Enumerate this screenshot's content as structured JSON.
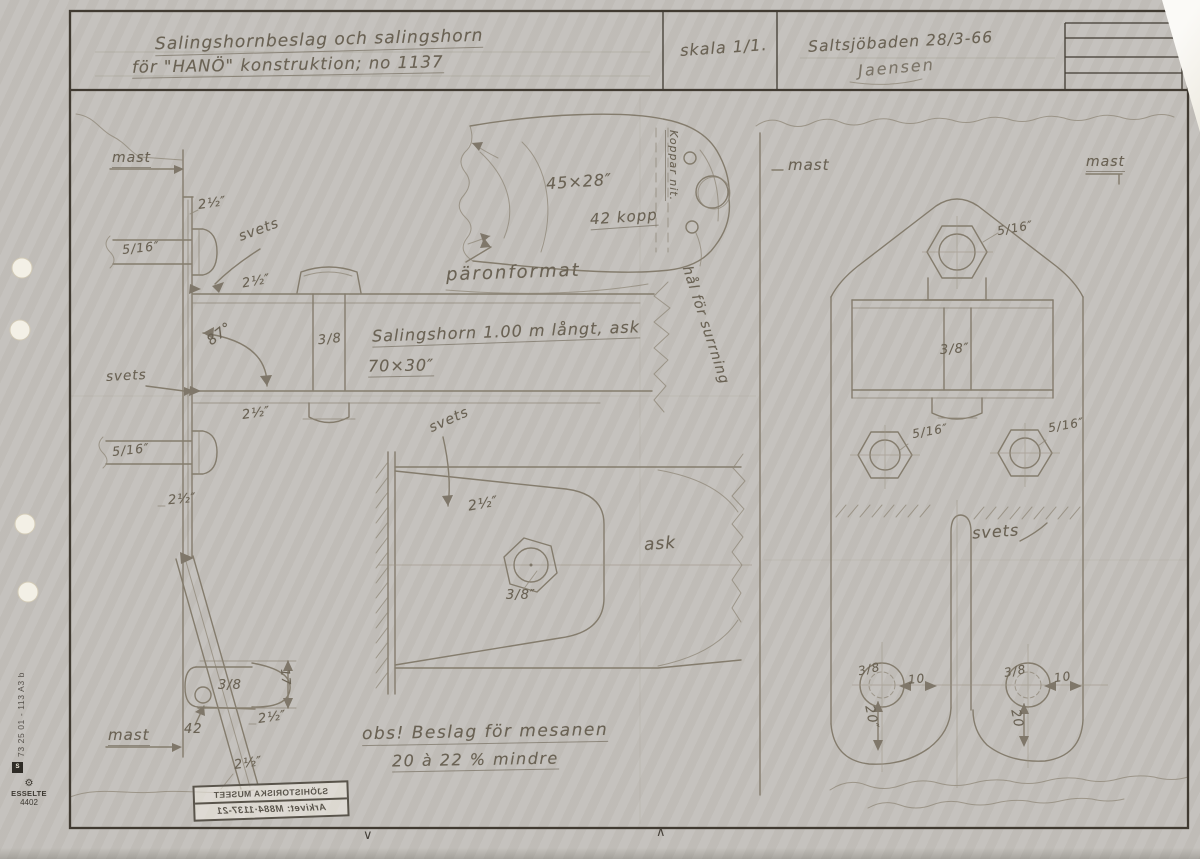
{
  "title_block": {
    "title_line1": "Salingshornbeslag och salingshorn",
    "title_line2": "för \"HANÖ\" konstruktion; no 1137",
    "scale": "skala 1/1.",
    "place_date": "Saltsjöbaden 28/3-66",
    "signature": "Jaensen"
  },
  "annotations": {
    "mast": "mast",
    "svets": "svets",
    "weld_angle": "87°",
    "dim_2_5in": "2½″",
    "dim_5_16in": "5/16″",
    "dim_3_8": "3/8",
    "dim_3_8in": "3/8″",
    "spar_note_line1": "Salingshorn 1.00 m långt, ask",
    "spar_note_line2": "70×30″",
    "tip_dim": "45×28″",
    "rivet_count": "42 kopp",
    "rivet_note": "Koppar nit.",
    "pear_shape": "päronformat",
    "lashing_hole": "hål för surrning",
    "wood": "ask",
    "dim_10": "10",
    "dim_17": "17",
    "dim_20in": "20″",
    "dim_20": "20",
    "dim_42": "42",
    "note_line1": "obs! Beslag för mesanen",
    "note_line2": "20 à 22 % mindre"
  },
  "stamp": {
    "line1": "SJÖHISTORISKA MUSEET",
    "line2": "Arkivet: M884·1137-21"
  },
  "edge": {
    "code": "73 25 01 - 113 A3 b",
    "standards_mark": "S",
    "brand": "ESSELTE",
    "brand_no": "4402",
    "gear_icon": "⚙"
  },
  "fold_marks": {
    "left": "∨",
    "right": "∧"
  },
  "colors": {
    "paper": "#ebe5d6",
    "frame": "#413b32",
    "pencil": "#847c6d",
    "text": "#6a6254"
  }
}
